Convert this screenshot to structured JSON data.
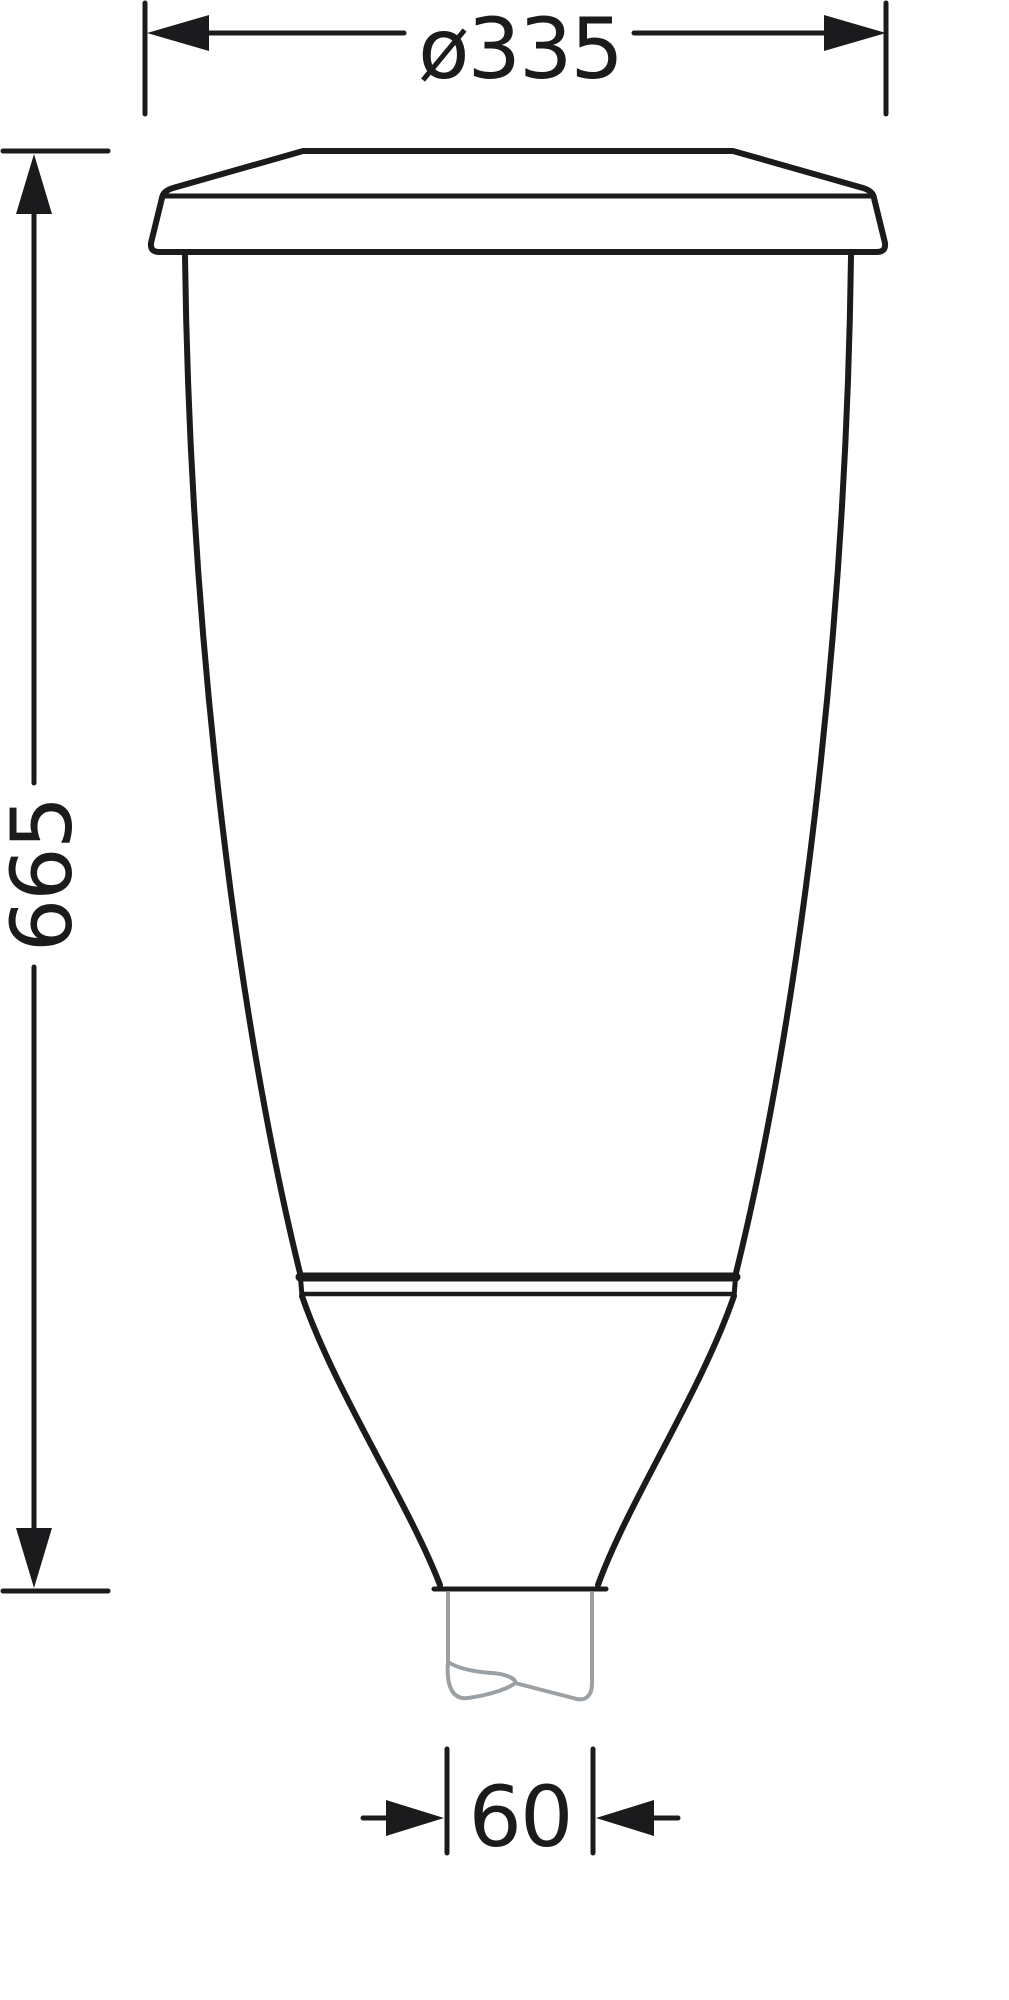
{
  "drawing": {
    "type": "technical-dimension-drawing",
    "subject": "post-top luminaire profile with pole spigot"
  },
  "dimensions": {
    "diameter": {
      "label": "ø335"
    },
    "height": {
      "label": "665"
    },
    "spigot": {
      "label": "60"
    }
  },
  "colors": {
    "line": "#1b1b1e",
    "pole": "#9aa0a3",
    "background": "#ffffff"
  }
}
